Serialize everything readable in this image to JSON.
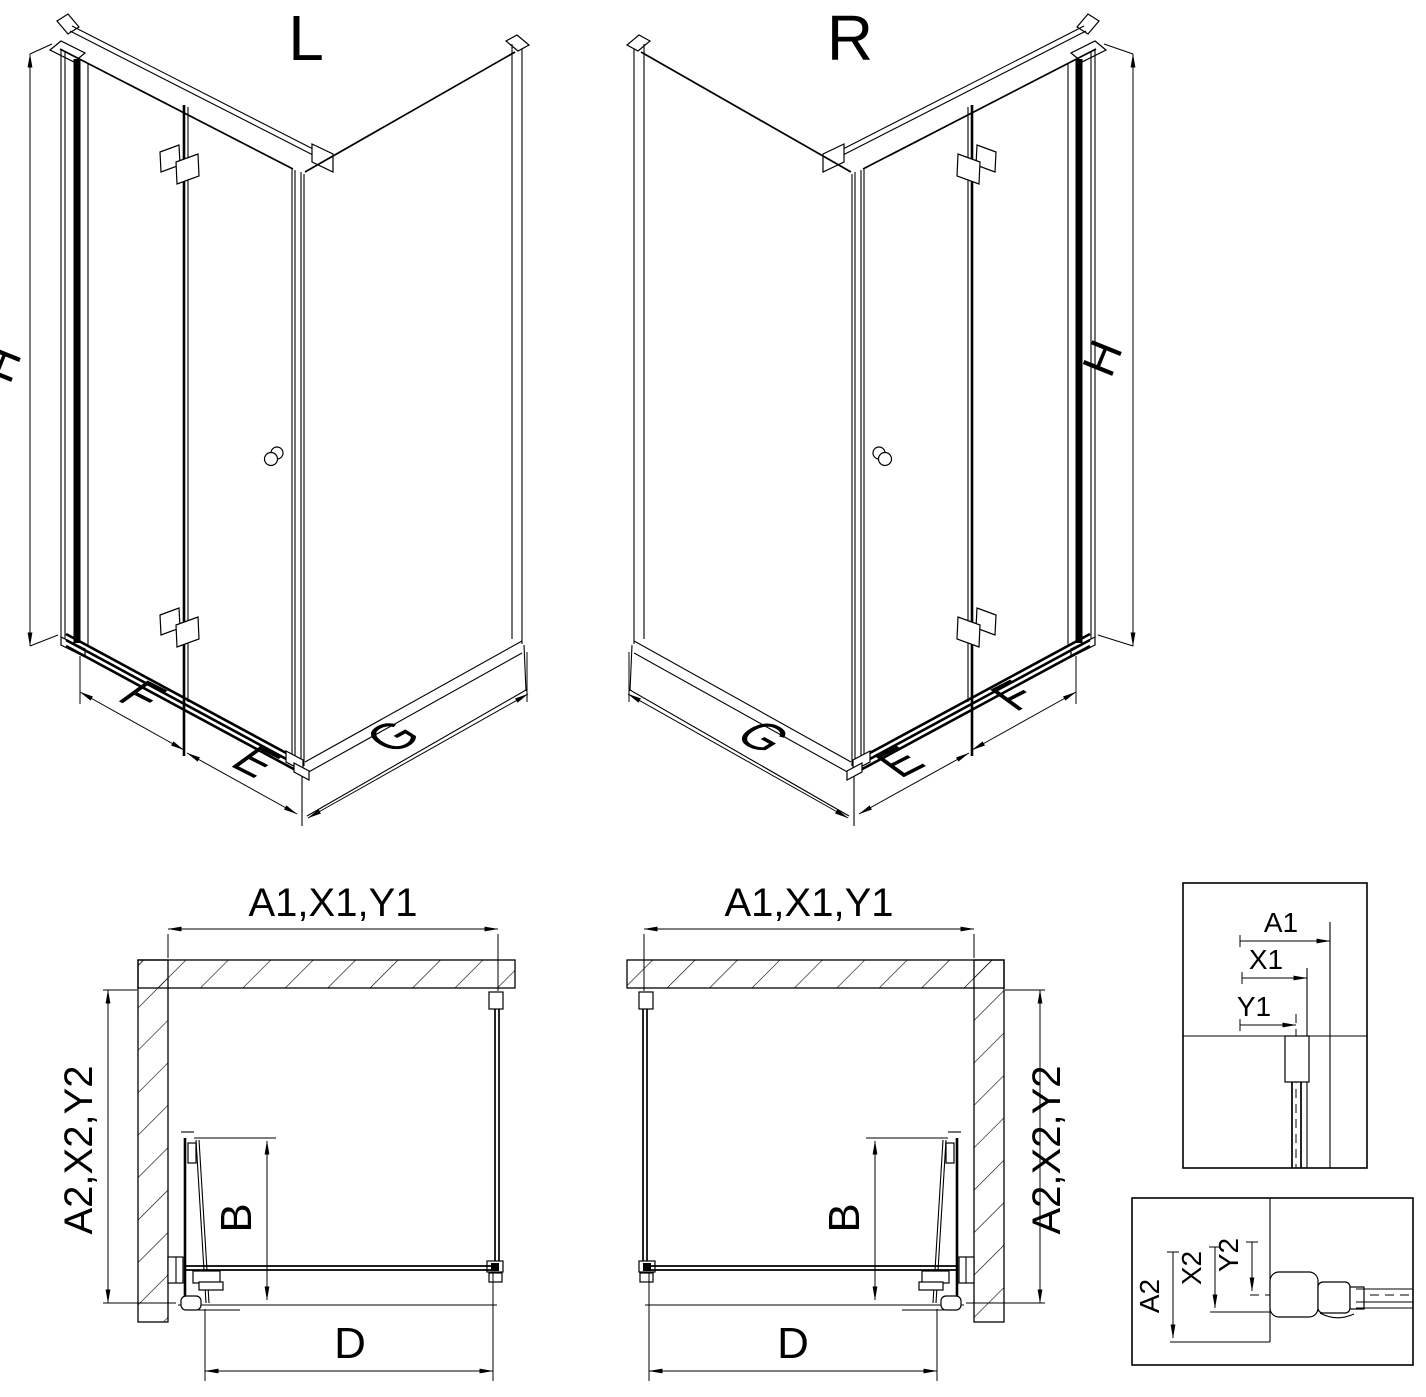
{
  "drawing": {
    "type": "shower-enclosure-technical-drawing",
    "colors": {
      "line": "#000000",
      "background": "#ffffff"
    },
    "views": {
      "iso_left": {
        "label": "L",
        "h_dim": "H",
        "f_dim": "F",
        "e_dim": "E",
        "g_dim": "G"
      },
      "iso_right": {
        "label": "R",
        "h_dim": "H",
        "f_dim": "F",
        "e_dim": "E",
        "g_dim": "G"
      },
      "plan_left": {
        "a1_dim": "A1,X1,Y1",
        "a2_dim": "A2,X2,Y2",
        "b_dim": "B",
        "d_dim": "D"
      },
      "plan_right": {
        "a1_dim": "A1,X1,Y1",
        "a2_dim": "A2,X2,Y2",
        "b_dim": "B",
        "d_dim": "D"
      },
      "detail_width": {
        "a1": "A1",
        "x1": "X1",
        "y1": "Y1"
      },
      "detail_depth": {
        "a2": "A2",
        "x2": "X2",
        "y2": "Y2"
      }
    }
  }
}
